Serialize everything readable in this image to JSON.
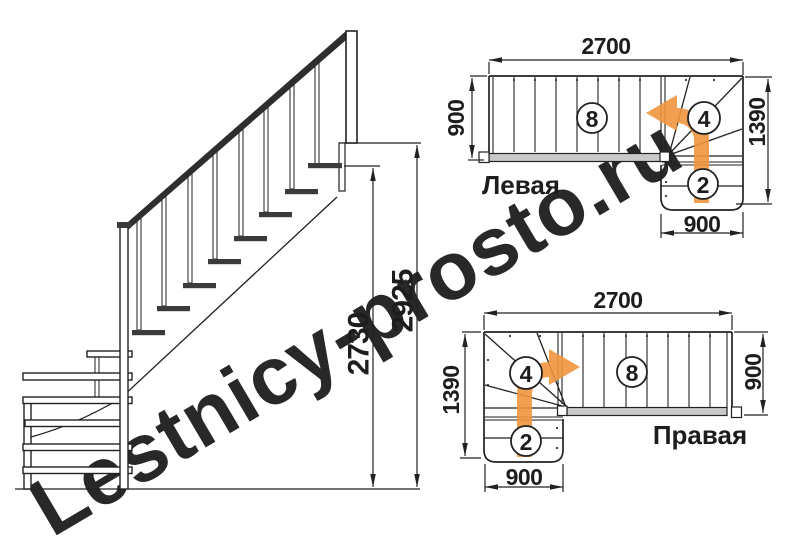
{
  "watermark": {
    "text": "Lestnicy-prosto.ru"
  },
  "colors": {
    "line": "#222222",
    "arrow": "#F0953D",
    "gray_strip": "#C9C9C9",
    "watermark": "#F1E09A"
  },
  "elevation": {
    "flight_height": "2730",
    "total_height": "2925"
  },
  "plan_left": {
    "label": "Левая",
    "length": "2700",
    "width": "900",
    "turn_depth": "1390",
    "exit_width": "900",
    "flight_steps": "8",
    "winder_steps": "4",
    "lower_steps": "2"
  },
  "plan_right": {
    "label": "Правая",
    "length": "2700",
    "width": "900",
    "turn_depth": "1390",
    "exit_width": "900",
    "flight_steps": "8",
    "winder_steps": "4",
    "lower_steps": "2"
  }
}
